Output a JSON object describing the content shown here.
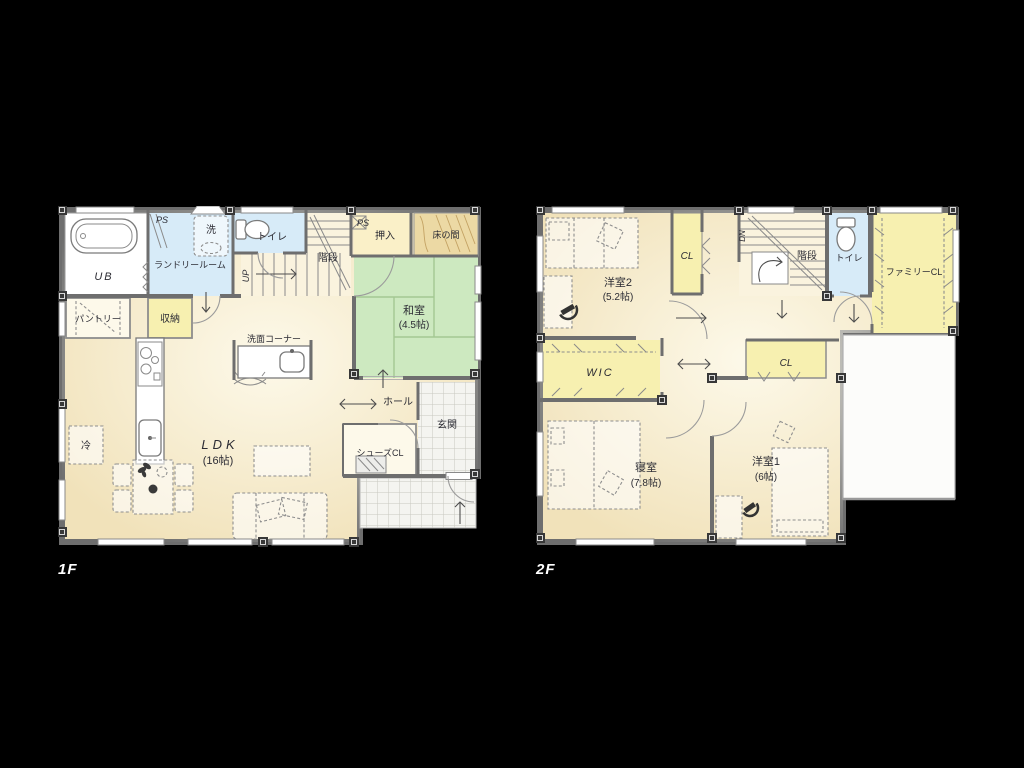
{
  "floor1": {
    "floor_label": "1F",
    "rooms": {
      "ub": "UB",
      "ps_left": "PS",
      "laundry": "ランドリールーム",
      "washer": "洗",
      "toilet": "トイレ",
      "stairs": "階段",
      "stairs_dir": "UP",
      "ps_right": "PS",
      "oshiire": "押入",
      "tokonoma": "床の間",
      "washitsu": "和室",
      "washitsu_size": "(4.5帖)",
      "pantry": "パントリー",
      "storage": "収納",
      "vanity": "洗面コーナー",
      "fridge": "冷",
      "ldk": "LDK",
      "ldk_size": "(16帖)",
      "hall": "ホール",
      "genkan": "玄関",
      "shoes_cl": "シューズCL"
    }
  },
  "floor2": {
    "floor_label": "2F",
    "rooms": {
      "yoshitsu2": "洋室2",
      "yoshitsu2_size": "(5.2帖)",
      "cl_north": "CL",
      "stairs": "階段",
      "stairs_dir": "DN",
      "toilet": "トイレ",
      "family_cl": "ファミリーCL",
      "wic": "WIC",
      "cl_center": "CL",
      "shinshitsu": "寝室",
      "shinshitsu_size": "(7.8帖)",
      "yoshitsu1": "洋室1",
      "yoshitsu1_size": "(6帖)"
    }
  },
  "colors": {
    "background": "#000000",
    "wall": "#6e6e6e",
    "floor_beige": "#f1e2ba",
    "floor_beige_light": "#faf3de",
    "tatami_green": "#cde9c0",
    "wet_blue": "#d7ebf8",
    "closet_yellow": "#f7f0b0",
    "wood_tan": "#ecd9a4",
    "tile_white": "#f4f4f0",
    "label_ink": "#2c2c34"
  }
}
